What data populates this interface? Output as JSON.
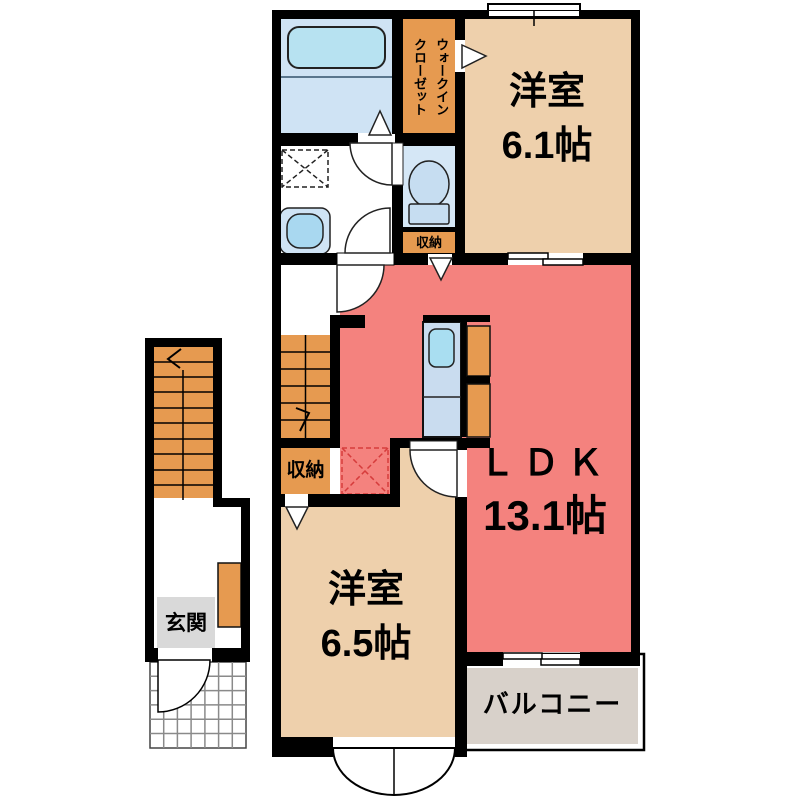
{
  "rooms": {
    "bedroom1": {
      "label": "洋室",
      "size": "6.1帖"
    },
    "bedroom2": {
      "label": "洋室",
      "size": "6.5帖"
    },
    "ldk": {
      "label": "ＬＤＫ",
      "size": "13.1帖"
    },
    "balcony": {
      "label": "バルコニー"
    },
    "entrance": {
      "label": "玄関"
    },
    "storage_upper": {
      "label": "収納"
    },
    "storage_lower": {
      "label": "収納"
    },
    "walk_in_closet": {
      "col_right": "ウォークイン",
      "col_left": "クローゼット"
    }
  },
  "fixtures": [
    "bathtub",
    "vanity-sink",
    "washing-machine-area",
    "toilet",
    "kitchen-counter",
    "refrigerator-space",
    "interior-stairs",
    "exterior-stairs",
    "entrance-door",
    "bay-window",
    "balcony-sliding-door"
  ],
  "colors": {
    "bedroom_beige": "#eed0ac",
    "ldk_salmon": "#f4827e",
    "accent_orange": "#e69a50",
    "bath_floor_blue": "#cfe3f4",
    "toilet_floor_blue": "#d5e7f6",
    "tub_blue": "#b7e2f1",
    "sink_blue": "#a9d8f0",
    "kitchen_counter_blue": "#c9dcef",
    "balcony_gray": "#d8d1ca",
    "entrance_mat_gray": "#d9d9d9",
    "dashed_red": "#d63c3c",
    "wall_black": "#000000"
  }
}
